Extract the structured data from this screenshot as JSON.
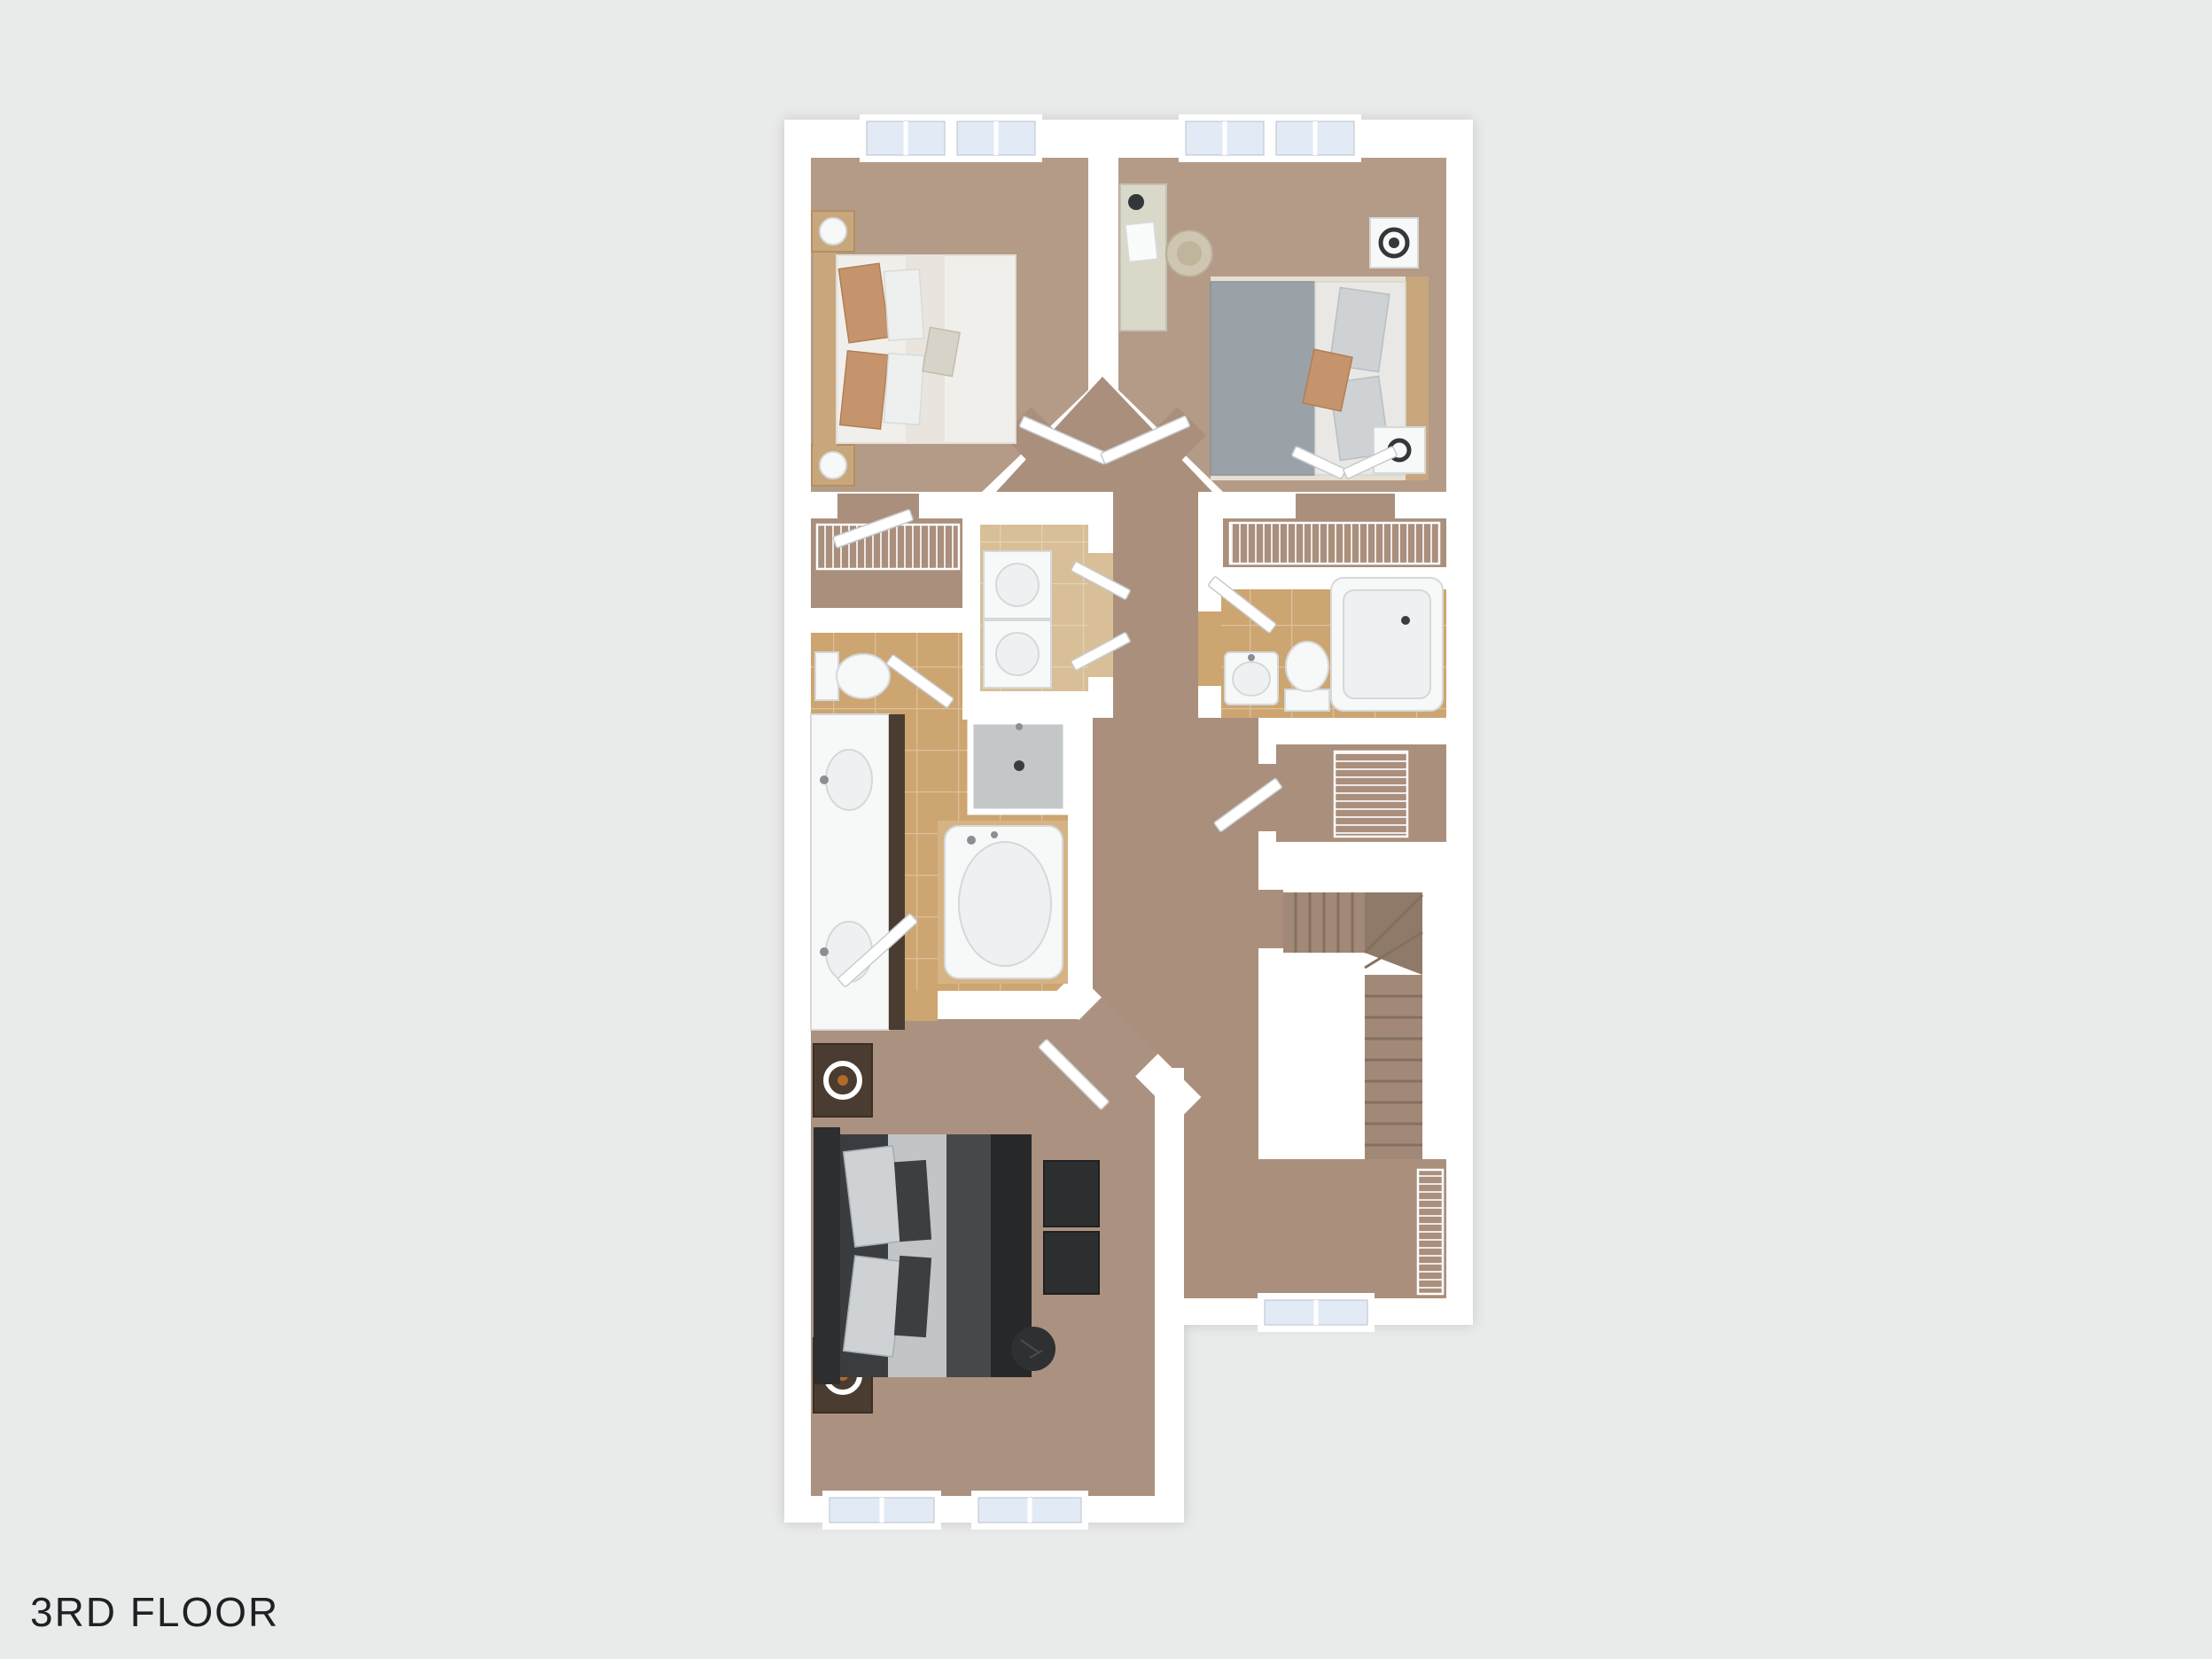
{
  "title": "3RD FLOOR",
  "colors": {
    "bg": "#e9eaea",
    "text": "#1e2124",
    "wall": "#ffffff",
    "wallEdge": "#d9dbdb",
    "carpetBedroom": "#b49b87",
    "carpetHall": "#a98f7c",
    "carpetMaster": "#ab9180",
    "tile": "#cda571",
    "tileLaundry": "#d8bf97",
    "glass": "#e2ebf5",
    "stair": "#a28977",
    "stairDark": "#8f7a68",
    "stairLine": "#83705f",
    "fixtureWhite": "#f7f8f8",
    "fixtureInner": "#eef1f1",
    "fixtureStroke": "#d5d8da",
    "showerFloor": "#c3c7c7",
    "woodLight": "#c8a77d",
    "woodDark": "#4a3c31",
    "headboardDark": "#2c2e30",
    "bedBase": "#3a3d40",
    "duvetDark": "#46494c",
    "duvetBlack": "#26282a",
    "sheetGray": "#c2c5c7",
    "duvetGray": "#9aa2a8",
    "sheetLight": "#e9e8e5",
    "pillowLight": "#ced2d5",
    "pillowTan": "#c6946c",
    "duvetWhite": "#f1efeb",
    "desk": "#d9d8c9",
    "chair": "#cfc6b1",
    "accentDark": "#34373a",
    "decorOrange": "#b06a2a"
  }
}
